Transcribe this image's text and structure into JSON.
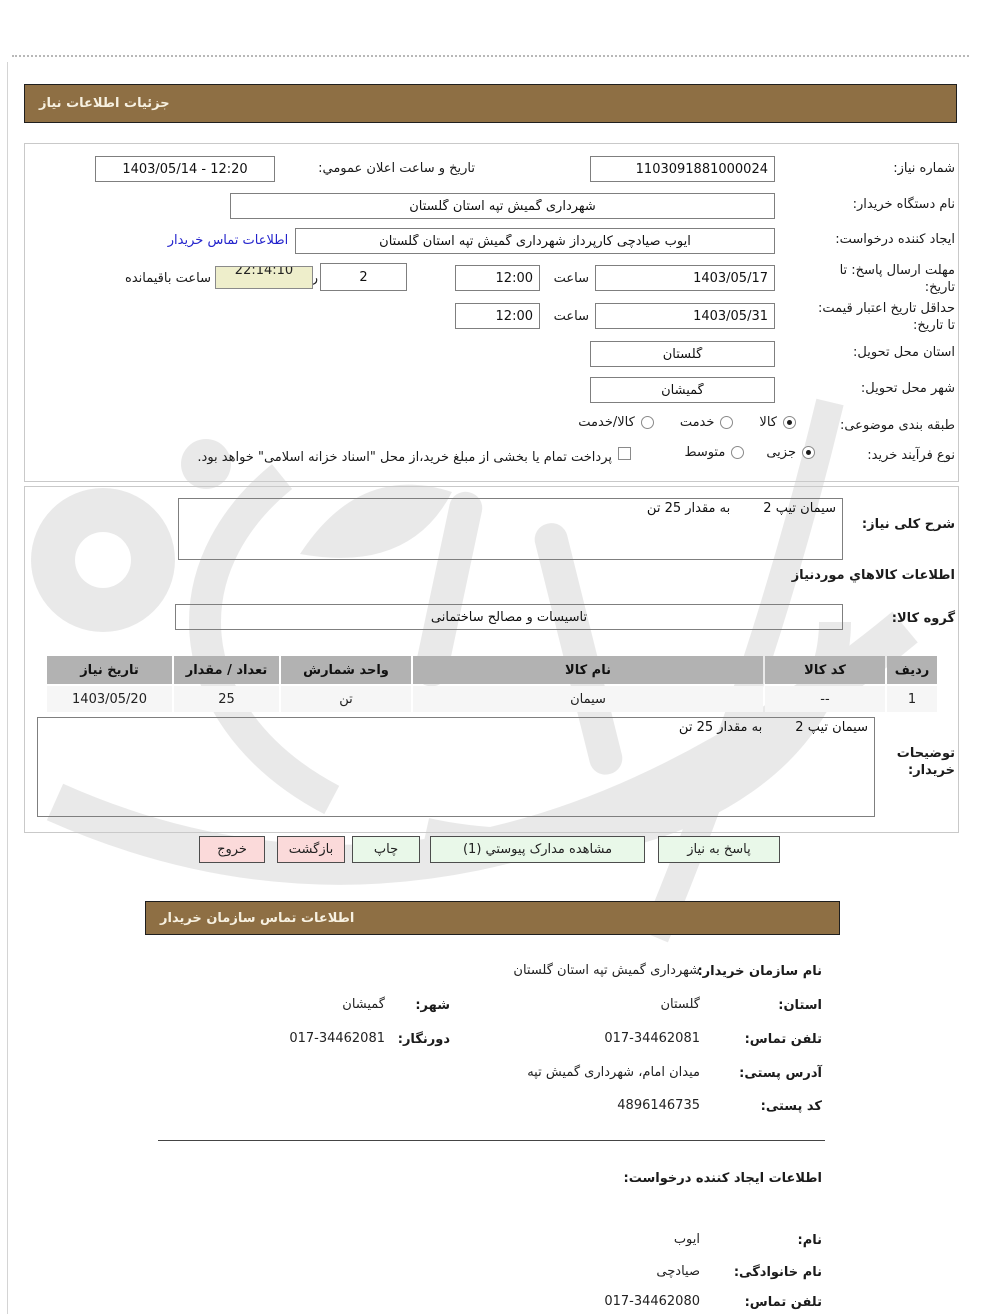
{
  "colors": {
    "header_bar": "#8e6f44",
    "button_green": "#e9f8e9",
    "button_pink": "#fbdada",
    "countdown_bg": "#eeeecb",
    "link_blue": "#2323cc",
    "table_header_gray": "#b2b2b2"
  },
  "bars": {
    "details_title": "جزئیات اطلاعات نیاز",
    "contact_title": "اطلاعات تماس سازمان خریدار"
  },
  "form": {
    "need_number": {
      "label": "شماره نیاز:",
      "value": "1103091881000024"
    },
    "announce_datetime": {
      "label": "تاریخ و ساعت اعلان عمومي:",
      "value": "1403/05/14 - 12:20"
    },
    "buyer_org_name": {
      "label": "نام دستگاه خریدار:",
      "value": "شهرداری گمیش تپه استان گلستان"
    },
    "request_creator": {
      "label": "ایجاد کننده درخواست:",
      "value": "ایوب صیادچی کارپرداز شهرداری گمیش تپه استان گلستان",
      "contact_link": "اطلاعات تماس خریدار"
    },
    "reply_deadline": {
      "label": "مهلت ارسال پاسخ: تا تاریخ:",
      "date": "1403/05/17",
      "hour_label": "ساعت",
      "hour": "12:00",
      "days": "2",
      "days_label": "روز و",
      "countdown": "22:14:10",
      "countdown_label": "ساعت باقیمانده"
    },
    "price_validity": {
      "label": "حداقل تاریخ اعتبار قیمت: تا تاریخ:",
      "date": "1403/05/31",
      "hour_label": "ساعت",
      "hour": "12:00"
    },
    "delivery_province": {
      "label": "استان محل تحویل:",
      "value": "گلستان"
    },
    "delivery_city": {
      "label": "شهر محل تحویل:",
      "value": "گمیشان"
    },
    "subject_class": {
      "label": "طبقه بندی موضوعی:",
      "options": [
        {
          "label": "کالا",
          "selected": true
        },
        {
          "label": "خدمت",
          "selected": false
        },
        {
          "label": "کالا/خدمت",
          "selected": false
        }
      ]
    },
    "process_type": {
      "label": "نوع فرآیند خرید:",
      "options": [
        {
          "label": "جزیی",
          "selected": true
        },
        {
          "label": "متوسط",
          "selected": false
        }
      ],
      "treasury_checkbox_label": "پرداخت تمام یا بخشی از مبلغ خرید،از محل \"اسناد خزانه اسلامی\" خواهد بود.",
      "treasury_checked": false
    }
  },
  "need_desc": {
    "label": "شرح کلی نیاز:",
    "value": "سیمان تیپ 2        به مقدار 25 تن"
  },
  "goods_info": {
    "heading": "اطلاعات کالاهاي موردنیاز",
    "group_label": "گروه کالا:",
    "group_value": "تاسیسات و مصالح ساختمانی",
    "table": {
      "headers": [
        "ردیف",
        "کد کالا",
        "نام کالا",
        "واحد شمارش",
        "تعداد / مقدار",
        "تاریخ نیاز"
      ],
      "rows": [
        [
          "1",
          "--",
          "سیمان",
          "تن",
          "25",
          "1403/05/20"
        ]
      ]
    }
  },
  "buyer_notes": {
    "label": "توضیحات خریدار:",
    "value": "سیمان تیپ 2        به مقدار 25 تن"
  },
  "buttons": {
    "respond": "پاسخ به نیاز",
    "view_attachments": "مشاهده مدارک پیوستي (1)",
    "print": "چاپ",
    "back": "بازگشت",
    "exit": "خروج"
  },
  "contact": {
    "org_name": {
      "label": "نام سازمان خریدار:",
      "value": "شهرداری گمیش تپه استان گلستان"
    },
    "province": {
      "label": "استان:",
      "value": "گلستان"
    },
    "city": {
      "label": "شهر:",
      "value": "گمیشان"
    },
    "phone": {
      "label": "تلفن تماس:",
      "value": "017-34462081"
    },
    "fax": {
      "label": "دورنگار:",
      "value": "017-34462081"
    },
    "address": {
      "label": "آدرس پستی:",
      "value": "میدان امام، شهرداری گمیش تپه"
    },
    "postal_code": {
      "label": "کد پستی:",
      "value": "4896146735"
    }
  },
  "creator": {
    "heading": "اطلاعات ایجاد کننده درخواست:",
    "first_name": {
      "label": "نام:",
      "value": "ایوب"
    },
    "last_name": {
      "label": "نام خانوادگی:",
      "value": "صیادچی"
    },
    "phone": {
      "label": "تلفن تماس:",
      "value": "017-34462080"
    }
  }
}
